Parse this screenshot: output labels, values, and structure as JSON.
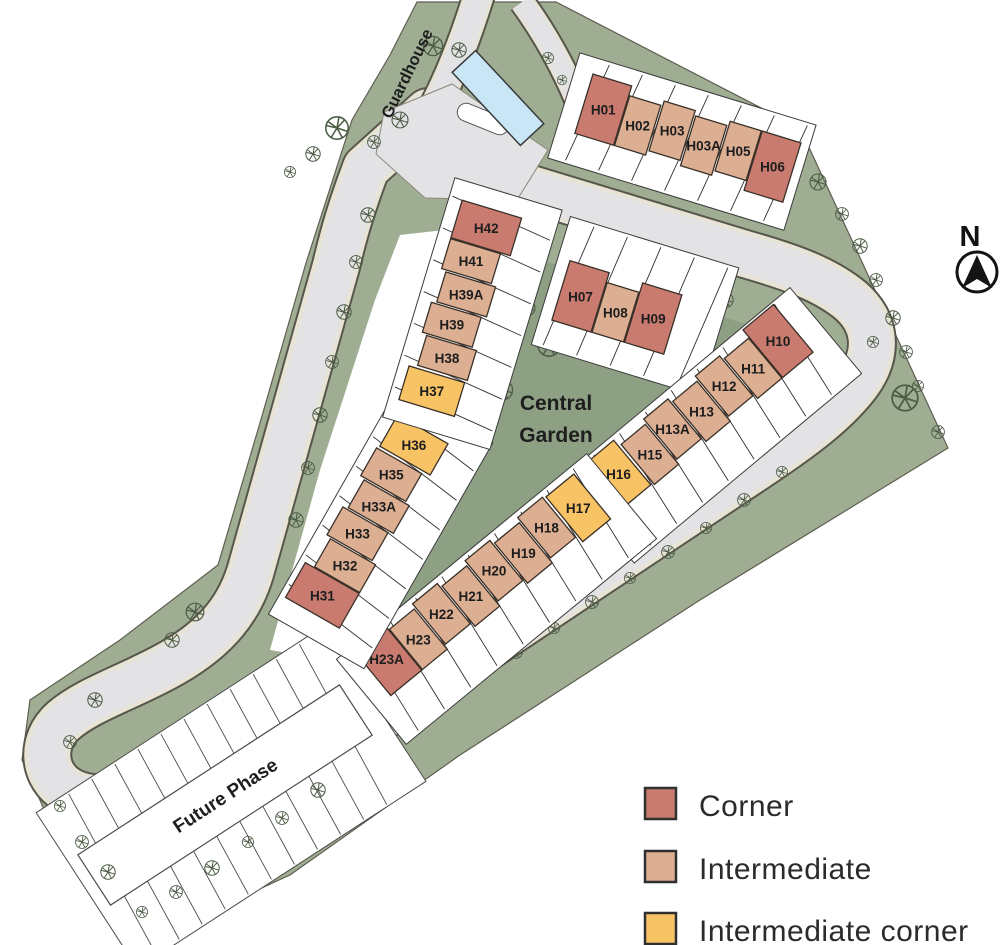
{
  "map": {
    "labels": {
      "guardhouse": "Guardhouse",
      "central_garden_line1": "Central",
      "central_garden_line2": "Garden",
      "future_phase": "Future Phase",
      "north_indicator": "N"
    },
    "rows": [
      {
        "id": "row-h01-h06",
        "houses": [
          {
            "id": "H01",
            "type": "corner"
          },
          {
            "id": "H02",
            "type": "intermediate"
          },
          {
            "id": "H03",
            "type": "intermediate"
          },
          {
            "id": "H03A",
            "type": "intermediate"
          },
          {
            "id": "H05",
            "type": "intermediate"
          },
          {
            "id": "H06",
            "type": "corner"
          }
        ]
      },
      {
        "id": "row-h07-h09",
        "houses": [
          {
            "id": "H07",
            "type": "corner"
          },
          {
            "id": "H08",
            "type": "intermediate"
          },
          {
            "id": "H09",
            "type": "corner"
          }
        ]
      },
      {
        "id": "row-h10-h16",
        "houses": [
          {
            "id": "H16",
            "type": "intermediate_corner"
          },
          {
            "id": "H15",
            "type": "intermediate"
          },
          {
            "id": "H13A",
            "type": "intermediate"
          },
          {
            "id": "H13",
            "type": "intermediate"
          },
          {
            "id": "H12",
            "type": "intermediate"
          },
          {
            "id": "H11",
            "type": "intermediate"
          },
          {
            "id": "H10",
            "type": "corner"
          }
        ]
      },
      {
        "id": "row-h17-h23a",
        "houses": [
          {
            "id": "H23A",
            "type": "corner"
          },
          {
            "id": "H23",
            "type": "intermediate"
          },
          {
            "id": "H22",
            "type": "intermediate"
          },
          {
            "id": "H21",
            "type": "intermediate"
          },
          {
            "id": "H20",
            "type": "intermediate"
          },
          {
            "id": "H19",
            "type": "intermediate"
          },
          {
            "id": "H18",
            "type": "intermediate"
          },
          {
            "id": "H17",
            "type": "intermediate_corner"
          }
        ]
      },
      {
        "id": "row-h31-h36",
        "houses": [
          {
            "id": "H31",
            "type": "corner"
          },
          {
            "id": "H32",
            "type": "intermediate"
          },
          {
            "id": "H33",
            "type": "intermediate"
          },
          {
            "id": "H33A",
            "type": "intermediate"
          },
          {
            "id": "H35",
            "type": "intermediate"
          },
          {
            "id": "H36",
            "type": "intermediate_corner"
          }
        ]
      },
      {
        "id": "row-h37-h42",
        "houses": [
          {
            "id": "H37",
            "type": "intermediate_corner"
          },
          {
            "id": "H38",
            "type": "intermediate"
          },
          {
            "id": "H39",
            "type": "intermediate"
          },
          {
            "id": "H39A",
            "type": "intermediate"
          },
          {
            "id": "H41",
            "type": "intermediate"
          },
          {
            "id": "H42",
            "type": "corner"
          }
        ]
      }
    ]
  },
  "legend": {
    "items": [
      {
        "label": "Corner",
        "type": "corner"
      },
      {
        "label": "Intermediate",
        "type": "intermediate"
      },
      {
        "label": "Intermediate corner",
        "type": "intermediate_corner"
      }
    ]
  },
  "colors": {
    "corner": "#c97b70",
    "intermediate": "#dcae92",
    "intermediate_corner": "#f8c365",
    "garden_green": "#8da084",
    "site_green": "#9fae93",
    "road_gray": "#e3e3e5",
    "kerb": "#e8e4d5",
    "road_outline": "#57564b",
    "guardhouse_blue": "#c9e6f7"
  }
}
